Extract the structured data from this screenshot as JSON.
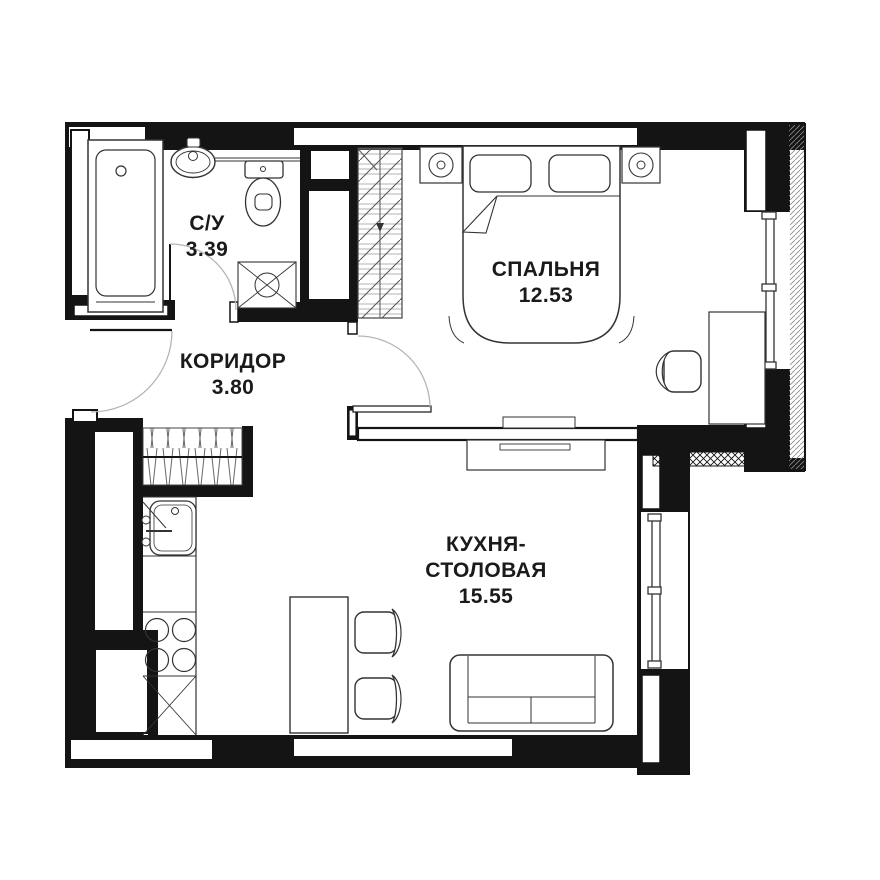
{
  "plan": {
    "type": "apartment-floor-plan",
    "rooms": [
      {
        "key": "bathroom",
        "label": "С/У",
        "area": "3.39"
      },
      {
        "key": "corridor",
        "label": "КОРИДОР",
        "area": "3.80"
      },
      {
        "key": "bedroom",
        "label": "СПАЛЬНЯ",
        "area": "12.53"
      },
      {
        "key": "kitchen_dining",
        "label_line1": "КУХНЯ-",
        "label_line2": "СТОЛОВАЯ",
        "area": "15.55"
      }
    ],
    "colors": {
      "wall": "#141414",
      "line": "#333333",
      "door_arc": "#b5b5b5",
      "bg": "#ffffff"
    }
  }
}
